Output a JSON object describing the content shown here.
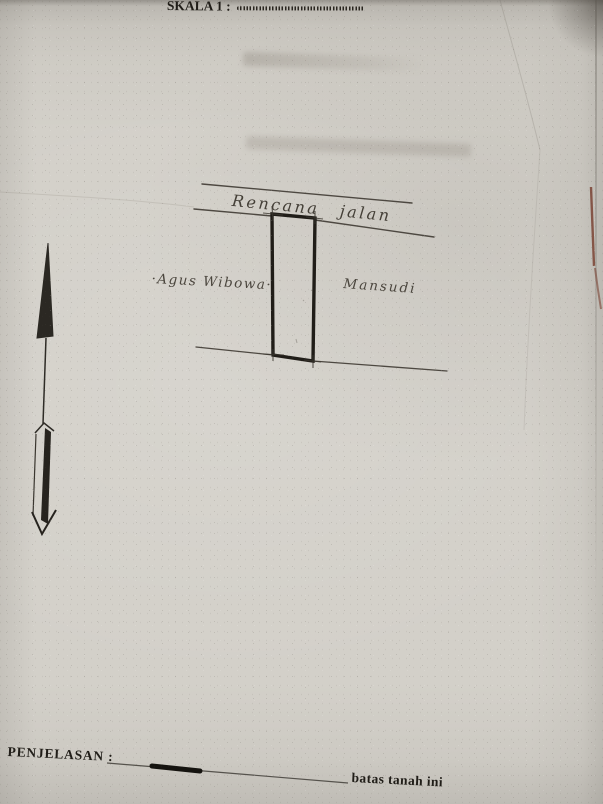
{
  "header": {
    "skala_label": "SKALA 1 :"
  },
  "sketch": {
    "road_label": "Rencana jalan",
    "left_owner_label": "·Agus Wibowa·",
    "right_owner_label": "Mansudi",
    "north_arrow_icon": "north-arrow-icon"
  },
  "legend": {
    "title": "PENJELASAN :",
    "boundary_symbol_icon": "thick-boundary-line-icon",
    "boundary_label": "batas tanah ini"
  },
  "colors": {
    "paper": "#d3d0c9",
    "ink": "#201d18",
    "handwriting_ink": "#4b463e",
    "stain_red": "#7a4334"
  }
}
